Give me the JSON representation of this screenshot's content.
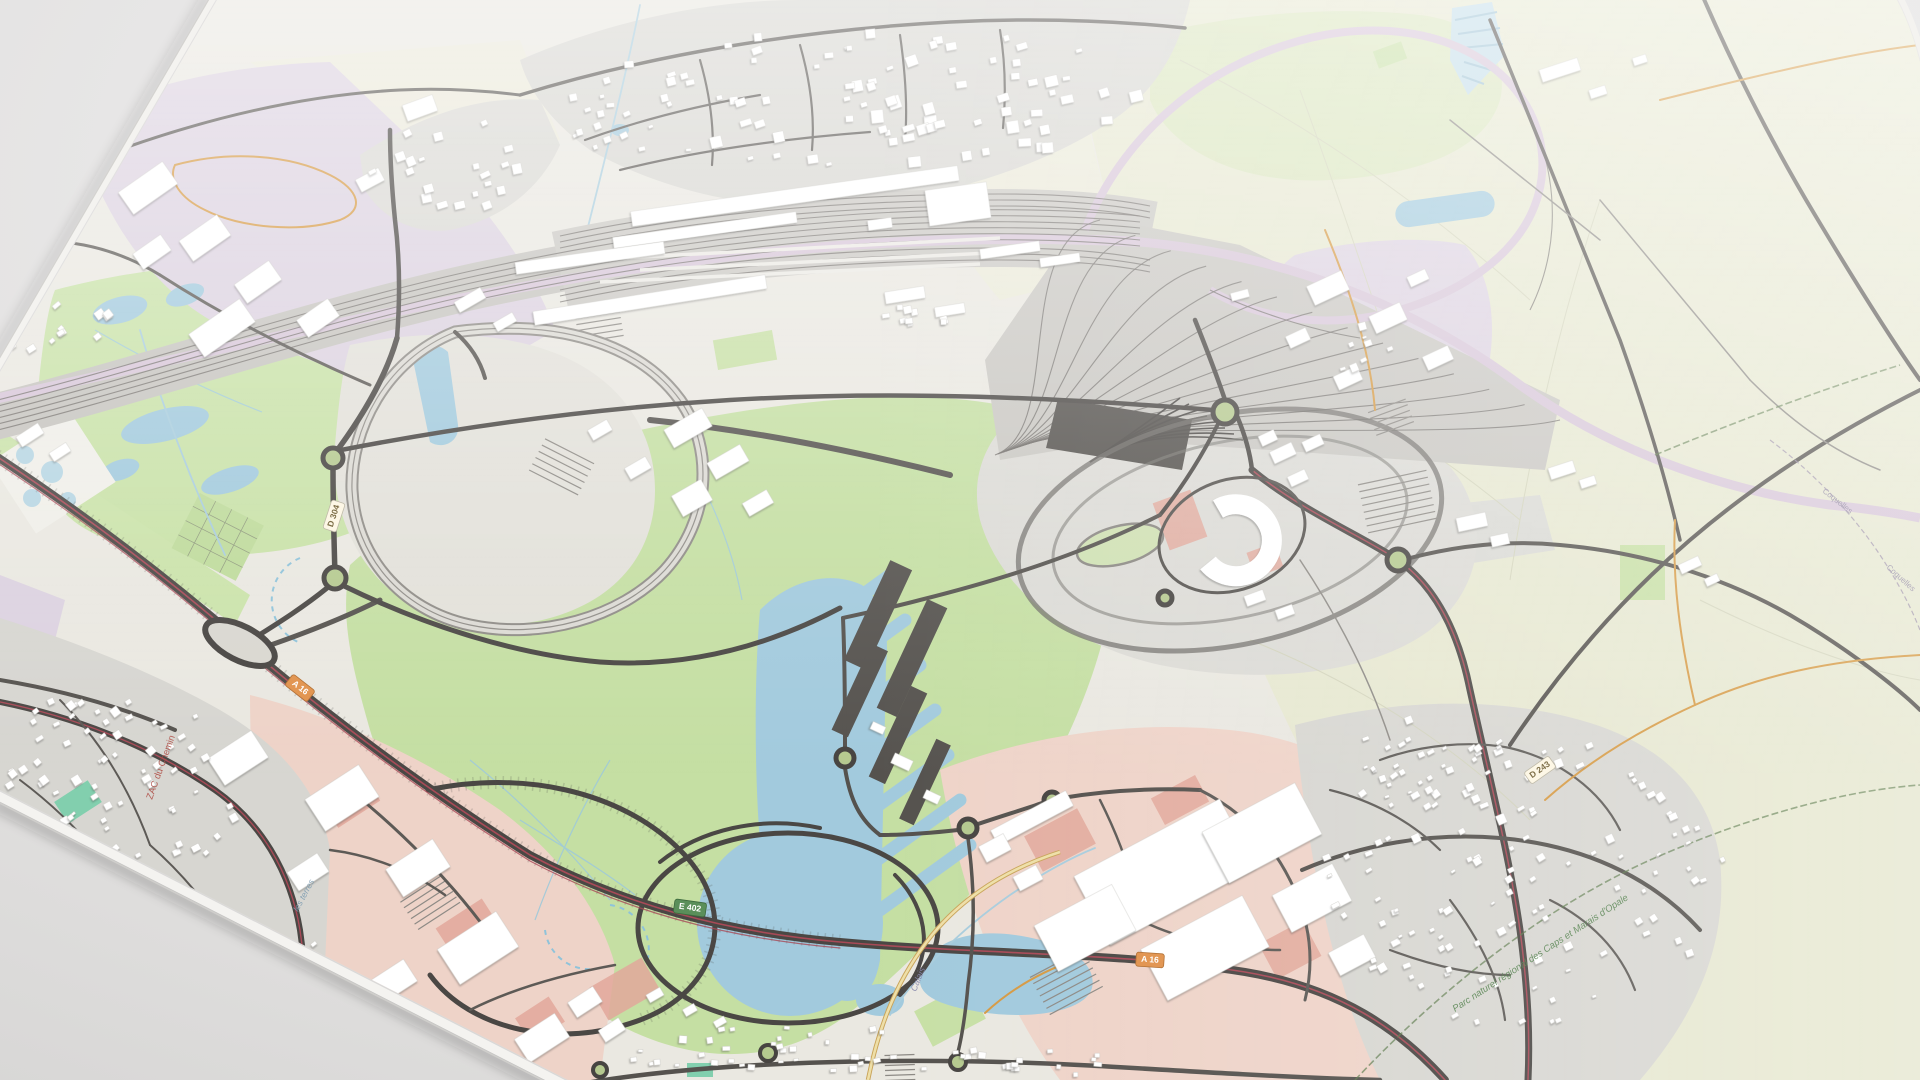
{
  "scene": {
    "type": "3d-rendered-paper-map",
    "area": "Channel Tunnel terminal, Coquelles / Calais-Frethun area",
    "surface": "light gray desk"
  },
  "labels": {
    "park_boundary": "Parc naturel régional des Caps et Marais d'Opale",
    "commune_boundary_1": "Coquelles",
    "commune_boundary_2": "Coquelles",
    "canal": "Calais",
    "lake": "les terres",
    "zac": "ZAC du Chemin"
  },
  "badges": [
    {
      "ref": "A 16",
      "style": "motorway-orange"
    },
    {
      "ref": "A 16",
      "style": "motorway-orange"
    },
    {
      "ref": "E 402",
      "style": "euro-green"
    },
    {
      "ref": "D 304",
      "style": "departmental-white"
    },
    {
      "ref": "D 243",
      "style": "departmental-white"
    }
  ],
  "palette": {
    "desk_gray": "#e4e3e2",
    "map_base": "#eae8e1",
    "field_green": "#c5dfa3",
    "field_pale_olive": "#e7e8d1",
    "urban_gray": "#d8d7d2",
    "industrial_purple": "#dcd2e0",
    "retail_pink": "#efd4c9",
    "plaza_red": "#e2a89b",
    "water_blue": "#a2cadd",
    "rail_ballast": "#c6c4bf",
    "rail_lgv_lavender": "#d7c6d8",
    "road_dark": "#4a4744",
    "motorway_red_line": "#a84a57",
    "roundabout_green": "#b5c98f",
    "path_orange": "#d69a44",
    "building_white": "#ffffff",
    "park_boundary_green": "#4e7d48"
  }
}
